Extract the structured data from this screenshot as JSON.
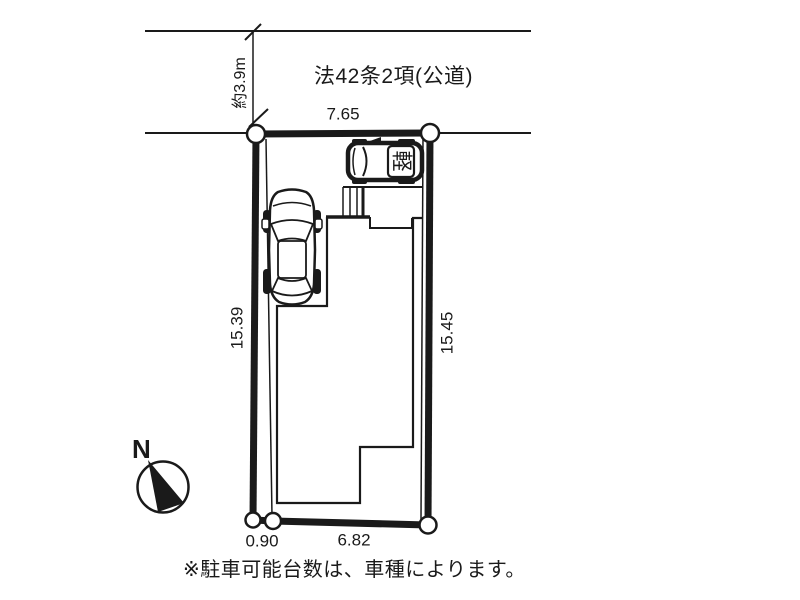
{
  "diagram": {
    "road": {
      "label": "法42条2項(公道)",
      "width_label": "約3.9m"
    },
    "dimensions": {
      "top": "7.65",
      "left": "15.39",
      "right": "15.45",
      "bottom": "6.82",
      "bottom_left": "0.90"
    },
    "compass": {
      "north_label": "N"
    },
    "vehicles": {
      "kei_badge": "軽"
    },
    "note": "※駐車可能台数は、車種によります。",
    "colors": {
      "ink": "#1a1a1a",
      "background": "#ffffff"
    }
  }
}
